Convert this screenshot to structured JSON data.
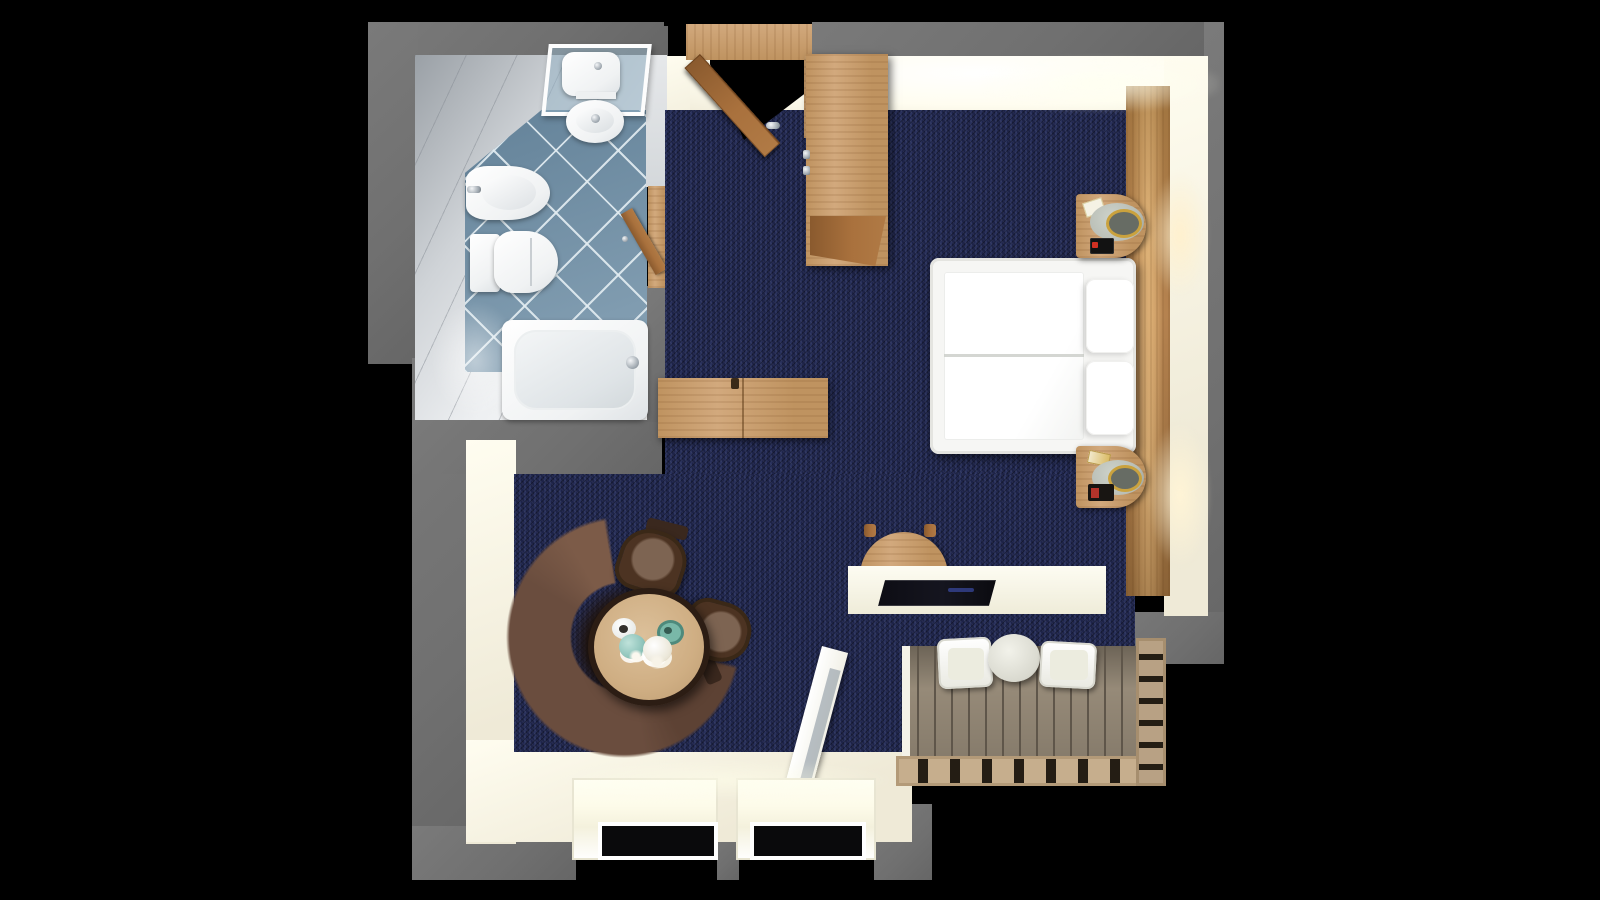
{
  "scene": {
    "title": "3D top-down floor plan render of a studio hotel room",
    "view": "bird's-eye (dollhouse) view",
    "background": "black"
  },
  "palette": {
    "background": "#000000",
    "outer_wall": "#707070",
    "inner_wall": "#efead7",
    "inner_wall_bright": "#fffdf0",
    "carpet": "#1d2348",
    "tile_blue": "#7796ac",
    "wood_light": "#d2a97d",
    "wood_mid": "#bf9360",
    "door_wood": "#a9713d",
    "headboard": "#b5824f",
    "sofa": "#6a4d3e",
    "chair_brown": "#4c3322",
    "chair_seat": "#7d6452",
    "table_wood": "#cfae83",
    "table_rim": "#2c1d14",
    "deck": "#968a78",
    "deck_gap": "#5f564a",
    "rail": "#c6ae8d",
    "rail_slat": "#241d14",
    "bed_white": "#ffffff",
    "lamp_gray": "#b7bcb4",
    "lamp_ring_gold": "#caa23e",
    "teal": "#79b8a8",
    "glass_dark": "#0a0a0c",
    "white_fixture": "#f0f2f3",
    "glow_warm": "#ffd696"
  },
  "rooms": {
    "bathroom": {
      "label": "Bathroom",
      "floor": "blue diagonal tiles",
      "fixtures": [
        "shower with glass screen",
        "pedestal sink",
        "bidet",
        "toilet",
        "bathtub",
        "wooden door (open)"
      ]
    },
    "main_room": {
      "label": "Bedroom / living room",
      "floor": "dark navy carpet",
      "furniture": [
        "entrance door (open)",
        "tall wardrobe",
        "console dresser",
        "double bed with two pillows",
        "wooden headboard wall panel",
        "nightstand with lamp (upper)",
        "nightstand with lamp (lower)",
        "curved brown sofa",
        "round coffee table with tea set",
        "two brown armchairs",
        "desk with chair and laptop",
        "two windows",
        "balcony door (open)"
      ]
    },
    "balcony": {
      "label": "Balcony",
      "floor": "wooden deck planks",
      "furniture": [
        "two white chairs",
        "small round table",
        "slatted railing"
      ]
    }
  },
  "furniture_labels": {
    "entrance_door": "Entrance door",
    "wardrobe": "Wardrobe",
    "console": "Console dresser",
    "bed": "Double bed",
    "sofa": "Curved sofa",
    "coffee_table": "Round coffee table",
    "desk": "Desk",
    "bathtub": "Bathtub",
    "toilet": "Toilet",
    "bidet": "Bidet",
    "sink": "Sink",
    "shower": "Shower",
    "balcony_door": "Balcony door",
    "window": "Window"
  }
}
